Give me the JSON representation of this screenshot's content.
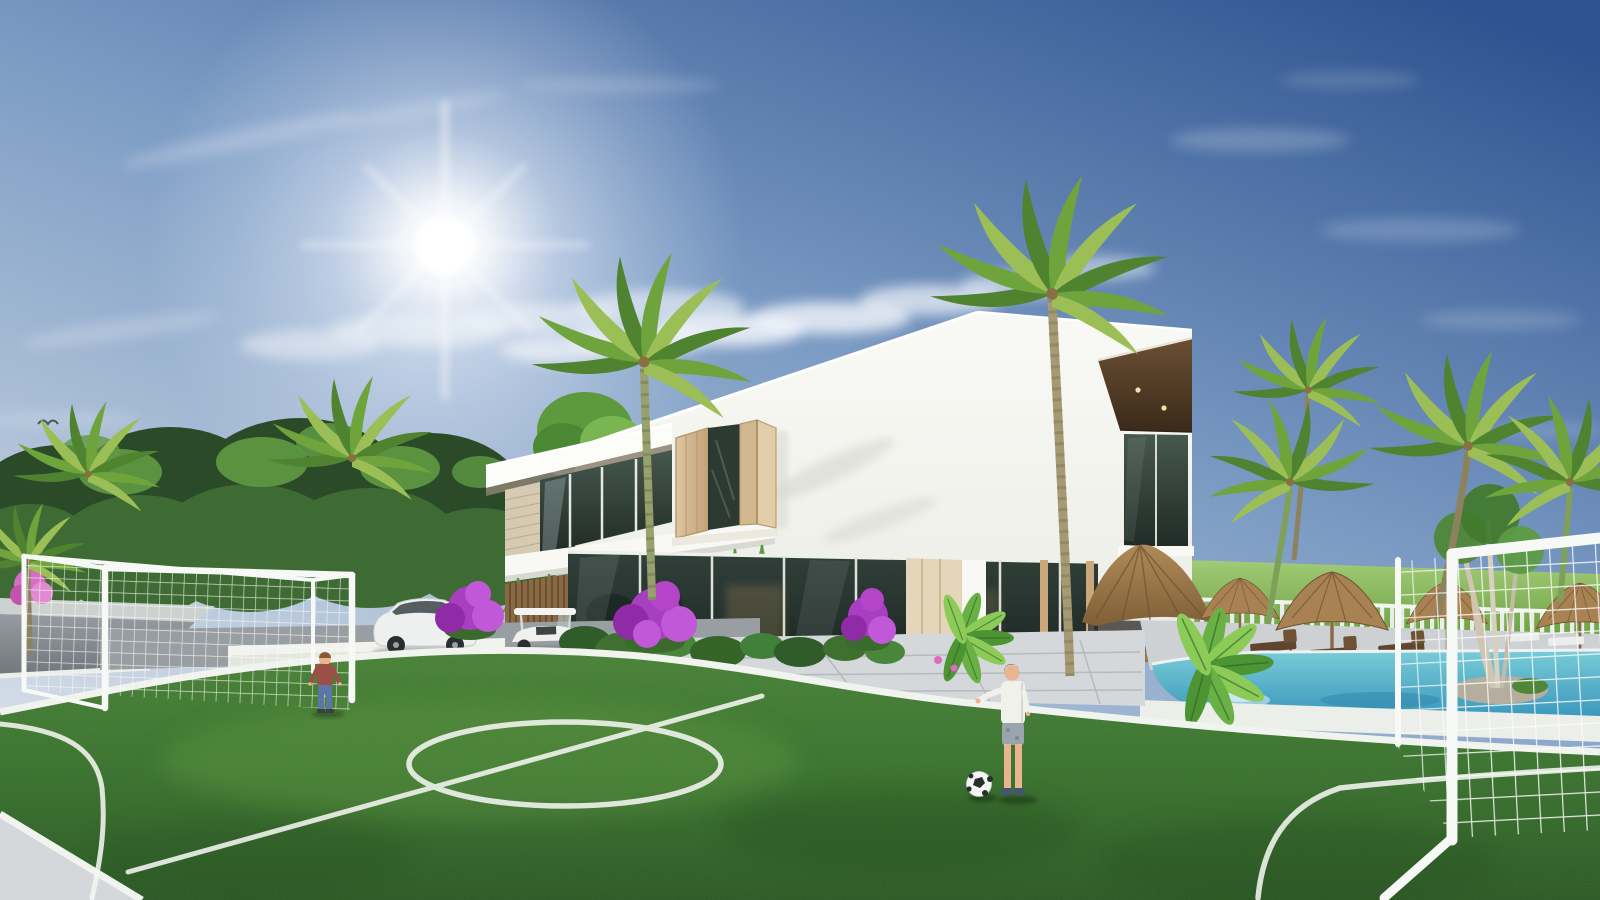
{
  "scene": {
    "type": "natural-image",
    "subject": "3D architectural rendering of a modern two-story white tropical villa with a private soccer lawn, swimming pool, thatched umbrellas and palm trees under a sunny blue sky",
    "sky": {
      "sun_position": "upper-left",
      "clouds": "scattered cumulus band across the middle of the sky"
    },
    "villa": {
      "stories": 2,
      "features": [
        "sloped-white-parapet-roof",
        "dark-wood-soffit-overhang",
        "open-wood-shutter-window",
        "glass-storefront-ground-floor",
        "hanging-fern-planter-ledge",
        "stone-accent-pier",
        "wood-slat-wall",
        "balcony-glass"
      ]
    },
    "field": {
      "surface": "artificial-grass",
      "markings": [
        "center-circle",
        "halfway-line",
        "penalty-arc-left",
        "penalty-arc-right"
      ],
      "goals": 2
    },
    "figures": [
      {
        "id": "boy-left",
        "shirt": "red",
        "pants": "blue-jeans"
      },
      {
        "id": "boy-center",
        "shirt": "white",
        "shorts": "gray",
        "item": "soccer-ball"
      }
    ],
    "vehicles": [
      "white-suv",
      "white-golf-cart"
    ],
    "pool_area": {
      "thatch_umbrellas": 4,
      "palapa": 1,
      "sun_loungers": 3,
      "fence": "white-picket",
      "island_tree": "multi-trunk"
    },
    "vegetation": [
      "palm-trees",
      "banana-plants",
      "purple-bougainvillea",
      "dense-tropical-tree-wall",
      "hanging-ferns",
      "green-meadow-horizon"
    ]
  },
  "palette": {
    "sky_top": "#2e5390",
    "sky_mid": "#7c9cc4",
    "sky_horizon": "#d8e0e9",
    "sun": "#ffffff",
    "cloud": "#f2f5fa",
    "foliage_dark": "#2a4a28",
    "foliage_mid": "#3e6b33",
    "foliage_light": "#5f9a43",
    "palm_green": "#6fa43c",
    "palm_dark": "#4f8330",
    "palm_light": "#9bbf56",
    "lawn_light": "#558f3b",
    "lawn": "#3f7a2e",
    "lawn_dark": "#2b5520",
    "field_line": "#f4f6f1",
    "building_white": "#f8f8f4",
    "building_shade": "#e3e5df",
    "soffit_wood": "#573f28",
    "shutter_wood": "#d8c19a",
    "glass_dark": "#2e3c36",
    "stone": "#d6cab2",
    "slat_wood": "#8a6a45",
    "door_wood": "#e5d6ba",
    "thatch": "#a88252",
    "thatch_dark": "#775834",
    "pool_light": "#79ccd8",
    "pool_deep": "#3795ba",
    "deck": "#cdd1d4",
    "fence_white": "#eef0ec",
    "meadow": "#86b95a",
    "road": "#8b9196",
    "paving": "#d5d8da",
    "skin": "#e9b48e",
    "hair": "#744828",
    "shirt_red": "#9c4f46",
    "jeans": "#5b77a8",
    "shirt_white": "#f1f1ec",
    "shorts_gray": "#9aa4ac",
    "goal_white": "#f7f9f6"
  }
}
